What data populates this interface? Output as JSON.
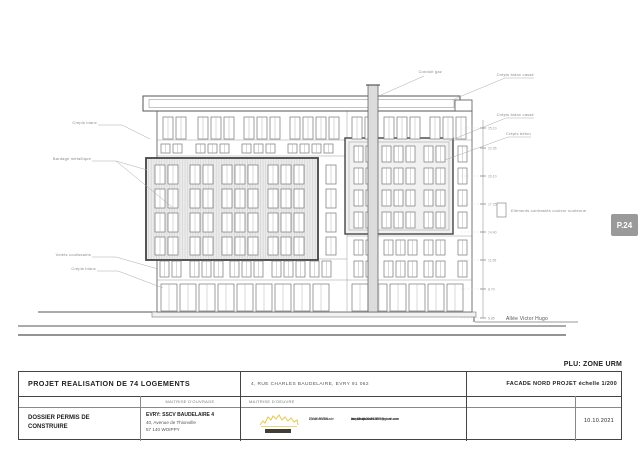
{
  "sheet": {
    "plu_note": "PLU: ZONE URM",
    "page_badge": "P.24",
    "date": "10.10.2021",
    "project_title": "PROJET REALISATION DE 74 LOGEMENTS",
    "project_address": "4, RUE CHARLES BAUDELAIRE, EVRY  91 062",
    "sheet_title": "FACADE NORD PROJET  échelle 1/200",
    "dossier_type": "DOSSIER PERMIS DE CONSTRUIRE",
    "moa_header": "MAITRISE D'OUVRAGE",
    "moe_header": "MAITRISE D'OEUVRE",
    "moa": {
      "line1": "EVRY: SSCV BAUDELAIRE 4",
      "line2": "40, Avenue de Thionville",
      "line3": "57 140 WOIPPY"
    },
    "moe": {
      "address1": "8, rue de l'Arcade",
      "address2": "75008 PARIS",
      "contact1": "lhuysmans.archi1978@gmail.com",
      "contact2": "www.lhuysmans-architecture.com",
      "contact3": "tel : 06 48 20 73 02"
    }
  },
  "drawing": {
    "labels": {
      "left1": "Crépis blanc",
      "left2": "Bardage métallique",
      "left3": "Volets coulissants",
      "left4": "Crépis blanc",
      "top1": "Conduit gaz",
      "right1": "Crépis blanc cassé",
      "right2": "Crépis blanc cassé",
      "right3": "Crépis béton",
      "legend": "Eléments contrastés couleur soutenue",
      "street": "Allée Victor Hugo"
    },
    "colors": {
      "line": "#555555",
      "hatch_fill": "#ececec",
      "badge": "#9a9a9a",
      "logo_yellow": "#e6c84f"
    }
  },
  "facade": {
    "window_rows": [
      {
        "y": 117,
        "h": 22,
        "w": 10,
        "groups": [
          [
            163,
            2
          ],
          [
            198,
            3
          ],
          [
            244,
            3
          ],
          [
            290,
            4
          ],
          [
            352,
            2
          ],
          [
            384,
            3
          ],
          [
            430,
            3
          ]
        ]
      },
      {
        "y": 144,
        "h": 9,
        "w": 9,
        "pitch": 12,
        "groups": [
          [
            161,
            2
          ],
          [
            196,
            3
          ],
          [
            242,
            3
          ],
          [
            288,
            4
          ]
        ]
      },
      {
        "y": 165,
        "h": 19,
        "w": 10,
        "groups": [
          [
            155,
            2
          ],
          [
            190,
            2
          ],
          [
            222,
            3
          ],
          [
            268,
            3
          ],
          [
            326,
            1
          ]
        ]
      },
      {
        "y": 189,
        "h": 19,
        "w": 10,
        "groups": [
          [
            155,
            2
          ],
          [
            190,
            2
          ],
          [
            222,
            3
          ],
          [
            268,
            3
          ],
          [
            326,
            1
          ]
        ]
      },
      {
        "y": 213,
        "h": 19,
        "w": 10,
        "groups": [
          [
            155,
            2
          ],
          [
            190,
            2
          ],
          [
            222,
            3
          ],
          [
            268,
            3
          ],
          [
            326,
            1
          ]
        ]
      },
      {
        "y": 237,
        "h": 18,
        "w": 10,
        "groups": [
          [
            155,
            2
          ],
          [
            190,
            2
          ],
          [
            222,
            3
          ],
          [
            268,
            3
          ],
          [
            326,
            1
          ]
        ]
      },
      {
        "y": 146,
        "h": 16,
        "w": 9,
        "pitch": 12,
        "groups": [
          [
            354,
            2
          ],
          [
            382,
            3
          ],
          [
            424,
            2
          ],
          [
            458,
            1
          ]
        ]
      },
      {
        "y": 168,
        "h": 16,
        "w": 9,
        "pitch": 12,
        "groups": [
          [
            354,
            2
          ],
          [
            382,
            3
          ],
          [
            424,
            2
          ],
          [
            458,
            1
          ]
        ]
      },
      {
        "y": 190,
        "h": 16,
        "w": 9,
        "pitch": 12,
        "groups": [
          [
            354,
            2
          ],
          [
            382,
            3
          ],
          [
            424,
            2
          ],
          [
            458,
            1
          ]
        ]
      },
      {
        "y": 212,
        "h": 16,
        "w": 9,
        "pitch": 12,
        "groups": [
          [
            354,
            2
          ],
          [
            382,
            3
          ],
          [
            424,
            2
          ],
          [
            458,
            1
          ]
        ]
      },
      {
        "y": 240,
        "h": 15,
        "w": 9,
        "pitch": 12,
        "groups": [
          [
            354,
            2
          ],
          [
            384,
            3
          ],
          [
            424,
            2
          ],
          [
            458,
            1
          ]
        ]
      },
      {
        "y": 261,
        "h": 16,
        "w": 9,
        "pitch": 12,
        "groups": [
          [
            160,
            2
          ],
          [
            190,
            3
          ],
          [
            230,
            3
          ],
          [
            272,
            3
          ],
          [
            310,
            2
          ],
          [
            354,
            2
          ],
          [
            384,
            3
          ],
          [
            424,
            2
          ],
          [
            458,
            1
          ]
        ]
      },
      {
        "y": 284,
        "h": 27,
        "w": 16,
        "pitch": 19,
        "groups": [
          [
            161,
            9
          ],
          [
            352,
            6
          ]
        ]
      }
    ],
    "elevation": {
      "x": 483,
      "ticks": [
        {
          "y": 128,
          "label": "25.10"
        },
        {
          "y": 148,
          "label": "22.95"
        },
        {
          "y": 176,
          "label": "20.10"
        },
        {
          "y": 204,
          "label": "17.25"
        },
        {
          "y": 232,
          "label": "14.40"
        },
        {
          "y": 260,
          "label": "11.55"
        },
        {
          "y": 289,
          "label": "8.70"
        },
        {
          "y": 318,
          "label": "5.85"
        }
      ]
    }
  }
}
